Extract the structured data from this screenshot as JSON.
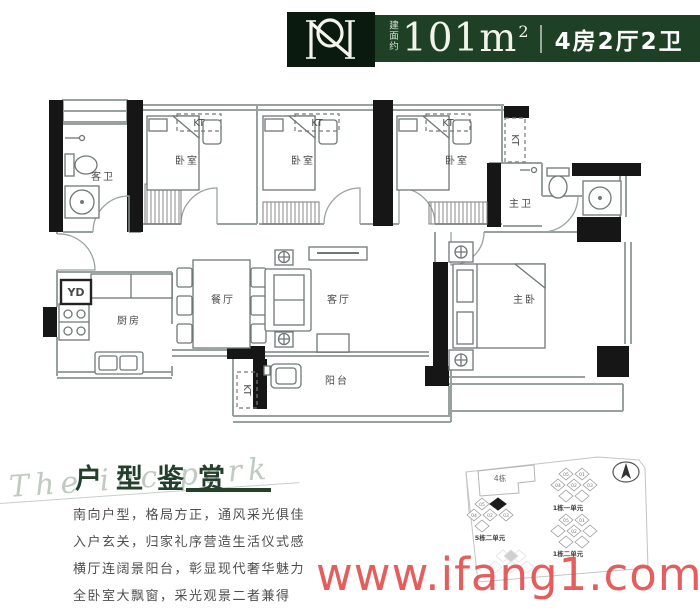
{
  "header": {
    "area_label": "建面约",
    "area_value": "101m",
    "area_sup": "2",
    "layout_text": "4房2厅2卫"
  },
  "floorplan": {
    "labels": {
      "guest_bath": "客卫",
      "bedroom": "卧室",
      "master_bath": "主卫",
      "master_bedroom": "主卧",
      "kitchen": "厨房",
      "dining_room": "餐厅",
      "living_room": "客厅",
      "balcony": "阳台"
    },
    "marks": {
      "ac": "KT",
      "laundry": "YD"
    }
  },
  "appreciation": {
    "script_text": "The inc park",
    "title": "户型鉴赏",
    "lines": [
      "南向户型，格局方正，通风采光俱佳",
      "入户玄关，归家礼序营造生活仪式感",
      "横厅连阔景阳台，彰显现代奢华魅力",
      "全卧室大飘窗，采光观景二者兼得"
    ]
  },
  "siteplan": {
    "building4_label": "4栋",
    "cluster_top_label": "1栋一单元",
    "cluster_left_label": "5栋二单元",
    "cluster_bottom_label": "1栋二单元",
    "unit_numbers": [
      "05",
      "01",
      "04",
      "02",
      "03"
    ]
  },
  "watermark": {
    "text": "www.ifang1.com",
    "color": "#e24a4a"
  },
  "colors": {
    "banner_green": "#1e4126",
    "logo_green": "#0b1a0f",
    "title_green": "#24402c",
    "watermark_red": "#e24a4a"
  }
}
